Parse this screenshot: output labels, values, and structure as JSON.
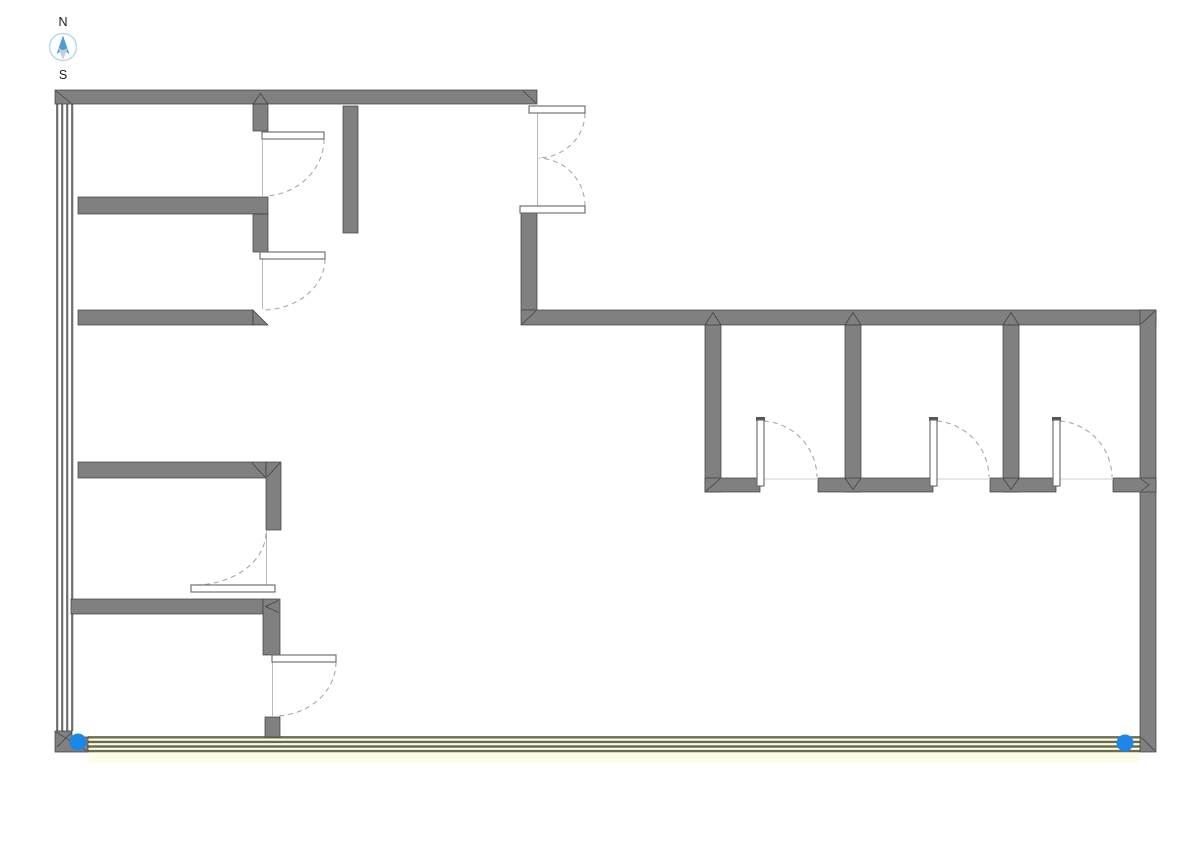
{
  "compass": {
    "north_label": "N",
    "south_label": "S"
  },
  "colors": {
    "background": "#ffffff",
    "wall_fill": "#808080",
    "wall_outline": "#3d3d3d",
    "window_line": "#6e6e6e",
    "door_panel_fill": "#ffffff",
    "door_panel_stroke": "#666666",
    "door_swing": "#a0a0a0",
    "door_jamb": "#b9b9b9",
    "selected_wall_fill": "#fdfde6",
    "selected_wall_stripe": "#6a6a50",
    "selected_wall_glow": "#fafad7",
    "selection_handle": "#1d87e8",
    "compass_ring": "#b9d9ef",
    "compass_north": "#4f9cd6",
    "compass_south": "#c9ced3"
  },
  "inventory": {
    "single_swing_doors": 7,
    "double_swing_doors": 1,
    "interior_rooms_right": 3,
    "window_walls": 2,
    "selection_handles": 2
  }
}
